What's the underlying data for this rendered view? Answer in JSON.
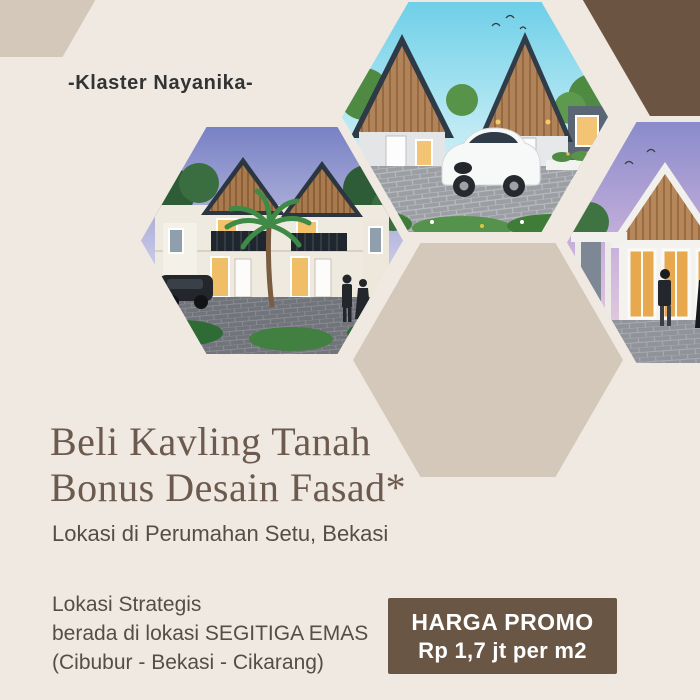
{
  "badge": {
    "label": "-Klaster Nayanika-"
  },
  "headline": {
    "line1": "Beli Kavling Tanah",
    "line2": "Bonus Desain Fasad*"
  },
  "location": {
    "text": "Lokasi di Perumahan Setu, Bekasi"
  },
  "strategic": {
    "line1": "Lokasi Strategis",
    "line2": "berada di lokasi SEGITIGA EMAS",
    "line3": "(Cibubur - Bekasi - Cikarang)"
  },
  "promo": {
    "title": "HARGA PROMO",
    "price": "Rp 1,7 jt per m2"
  },
  "colors": {
    "background": "#EFE9E1",
    "hexagon_tan": "#D4C8BA",
    "hexagon_brown": "#6B5442",
    "promo_box": "#6A5644",
    "promo_text": "#FFFFFF",
    "headline_text": "#6B5A4D",
    "body_text": "#574D45",
    "badge_text": "#333333"
  },
  "photos": {
    "top": {
      "alt": "Single-storey houses with tall wooden gable facades, a white hatchback car parked on a paver driveway under a bright blue sky"
    },
    "left": {
      "alt": "Two-storey cluster townhouses with wooden gables, balconies, a palm tree, a dark car and people at dusk"
    },
    "right": {
      "alt": "Single-storey house with wooden gable and lit glass doors, a family standing outside under a lavender dusk sky"
    }
  }
}
